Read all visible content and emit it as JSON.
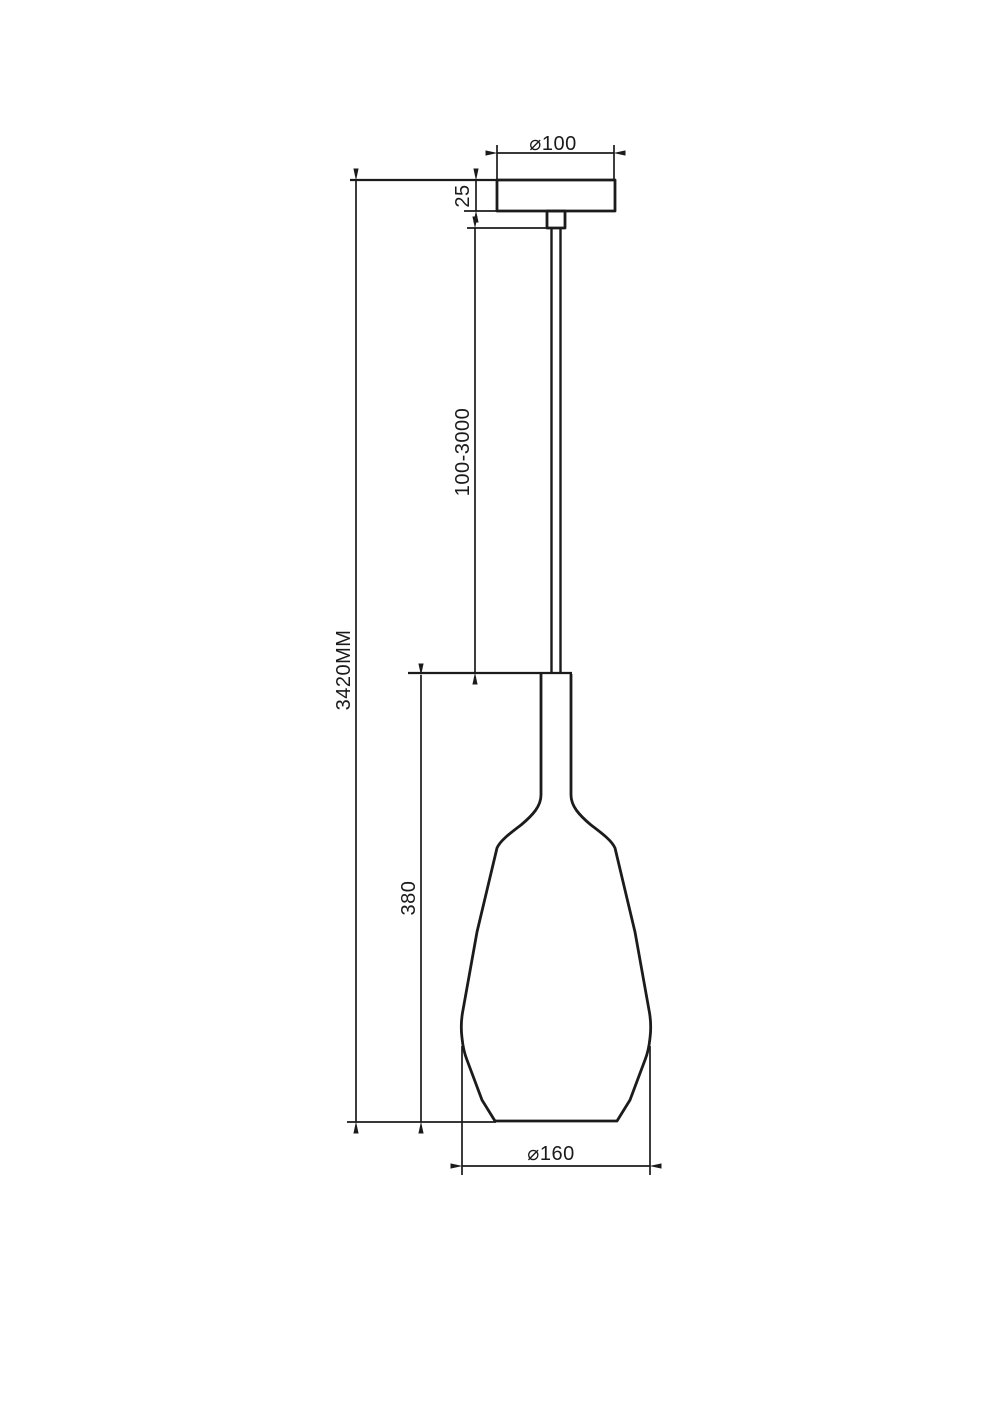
{
  "drawing": {
    "kind": "pendant-lamp-dimensional-drawing",
    "background": "#ffffff",
    "line_color": "#1b1b1b",
    "labels": {
      "canopy_diameter": "⌀100",
      "canopy_height": "25",
      "suspension_length": "100-3000",
      "overall_height": "3420MM",
      "shade_height": "380",
      "shade_diameter": "⌀160"
    }
  }
}
